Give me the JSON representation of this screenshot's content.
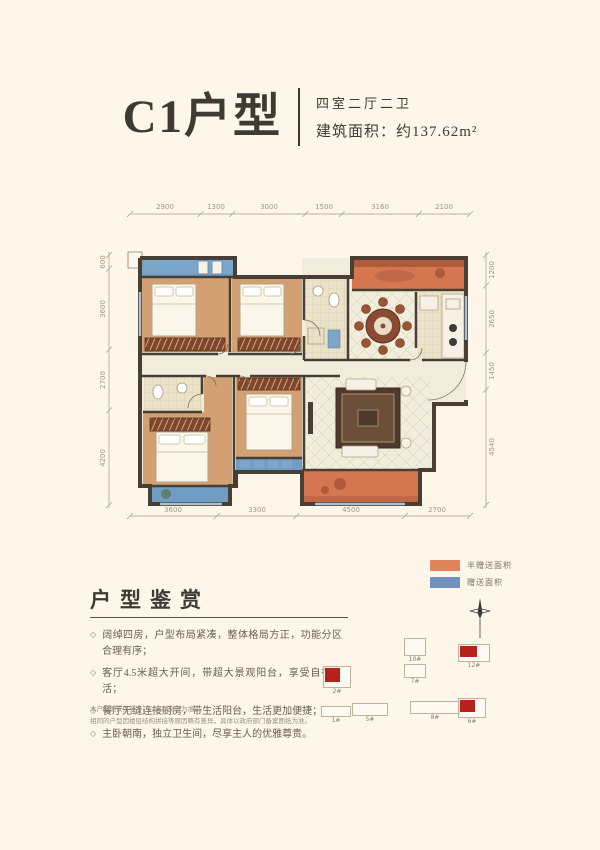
{
  "header": {
    "title": "C1户型",
    "rooms": "四室二厅二卫",
    "area": "建筑面积：约137.62m²"
  },
  "plan": {
    "dims_top": [
      "2900",
      "1300",
      "3000",
      "1500",
      "3160",
      "2100"
    ],
    "dims_bottom": [
      "3600",
      "3300",
      "4500",
      "2700"
    ],
    "dims_left": [
      "600",
      "3600",
      "2700",
      "4200"
    ],
    "dims_right": [
      "1200",
      "2650",
      "1450",
      "4540"
    ]
  },
  "legend": {
    "half_gift": {
      "label": "半赠送面积",
      "color": "#e0825c"
    },
    "gift": {
      "label": "赠送面积",
      "color": "#7092bd"
    }
  },
  "review": {
    "heading": "户型鉴赏",
    "bullets": [
      "阔绰四房，户型布局紧凑，整体格局方正，功能分区合理有序；",
      "客厅4.5米超大开间，带超大景观阳台，享受自在生活；",
      "餐厅无缝连接厨房，带生活阳台，生活更加便捷；",
      "主卧朝南，独立卫生间，尽享主人的优雅尊贵。"
    ],
    "disclaimer": [
      "本户型图仅供参考，以实际交付为准。",
      "相同的户型因楼层结构拼接等原因略有差异，具体以政府部门备案图纸为准。"
    ]
  },
  "sitemap": {
    "buildings": [
      {
        "label": "2#",
        "highlighted": true
      },
      {
        "label": "10#",
        "highlighted": false
      },
      {
        "label": "7#",
        "highlighted": false
      },
      {
        "label": "12#",
        "highlighted": true
      },
      {
        "label": "1#",
        "highlighted": false
      },
      {
        "label": "5#",
        "highlighted": false
      },
      {
        "label": "8#",
        "highlighted": false
      },
      {
        "label": "6#",
        "highlighted": true
      }
    ]
  },
  "colors": {
    "background": "#fdf6e9",
    "ink": "#3e3b33",
    "wall": "#473f33",
    "bedroom_floor": "#d2a072",
    "tile_floor": "#eae2c9",
    "light_floor": "#f1ecdc",
    "balcony_orange": "#d4764f",
    "balcony_blue": "#6f9dc3",
    "highlight_red": "#b5231f"
  }
}
